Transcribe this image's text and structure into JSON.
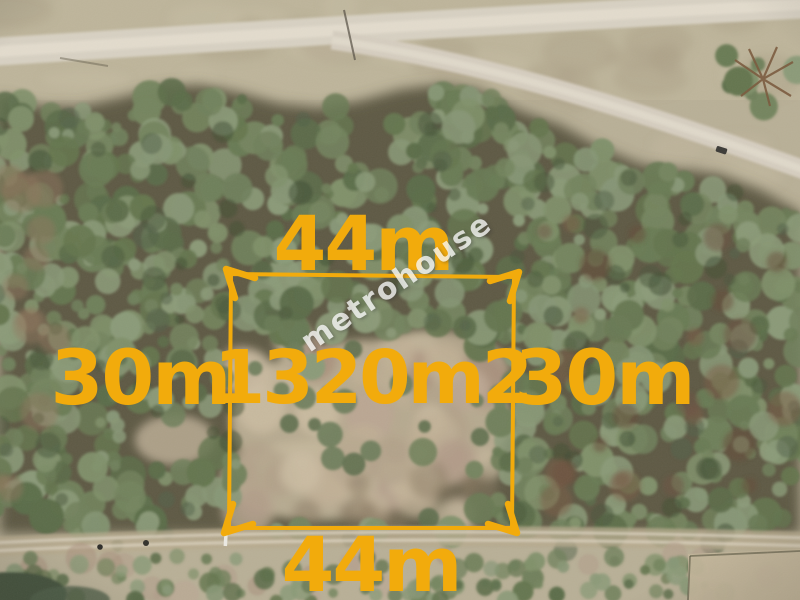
{
  "overlay": {
    "top_width_label": "44m",
    "bottom_width_label": "44m",
    "left_depth_label": "30m",
    "right_depth_label": "30m",
    "area_label": "1320m2",
    "line_color": "#F2AB0C"
  },
  "watermark": {
    "text": "metrohouse",
    "color": "#F8F8F8"
  }
}
